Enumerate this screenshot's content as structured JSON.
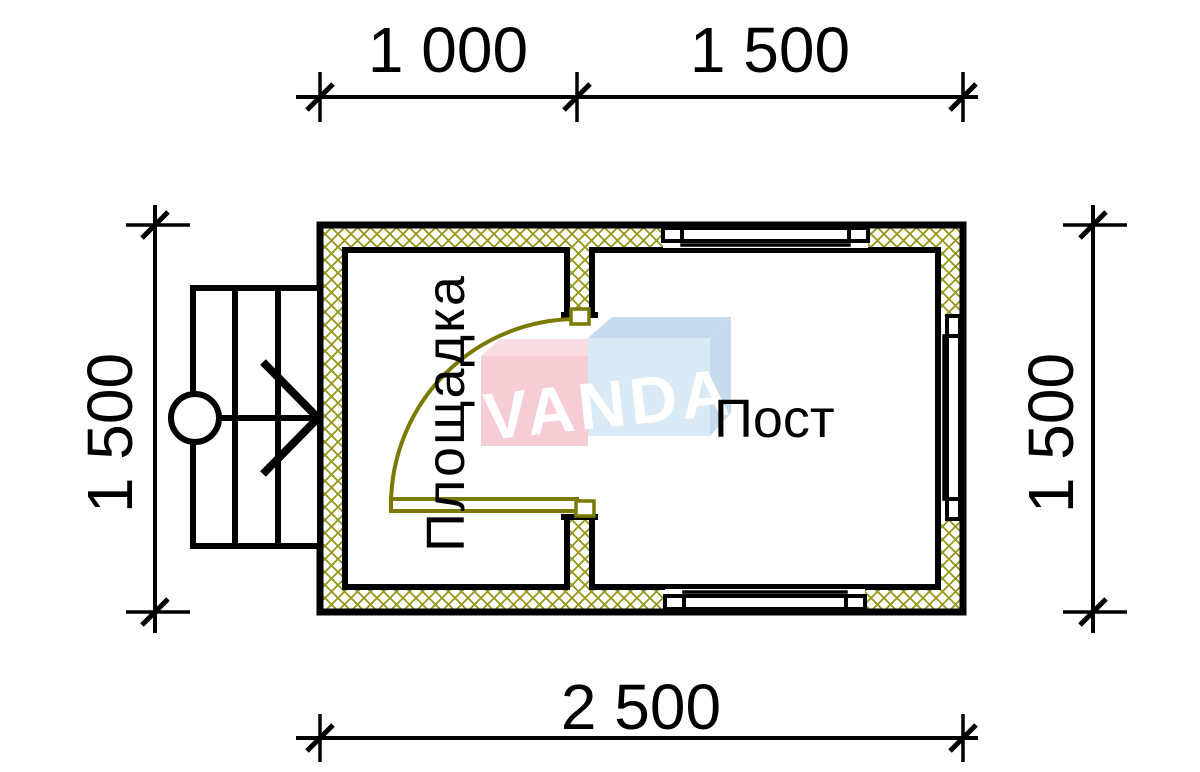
{
  "drawing": {
    "type": "floor-plan",
    "watermark": "VANDA",
    "rooms": [
      {
        "label": "Площадка"
      },
      {
        "label": "Пост"
      }
    ],
    "dimensions": {
      "top_left": "1 000",
      "top_right": "1 500",
      "bottom": "2 500",
      "left": "1 500",
      "right": "1 500"
    },
    "colors": {
      "line": "#000000",
      "wall_hatch": "#969617",
      "door": "#7a7a00",
      "logo_pink": "#f6ccd5",
      "logo_pink_top": "#fadce3",
      "logo_blue": "#d9e9f5",
      "logo_blue_shade": "#c6dcee",
      "logo_letters": "#ffffff"
    }
  }
}
